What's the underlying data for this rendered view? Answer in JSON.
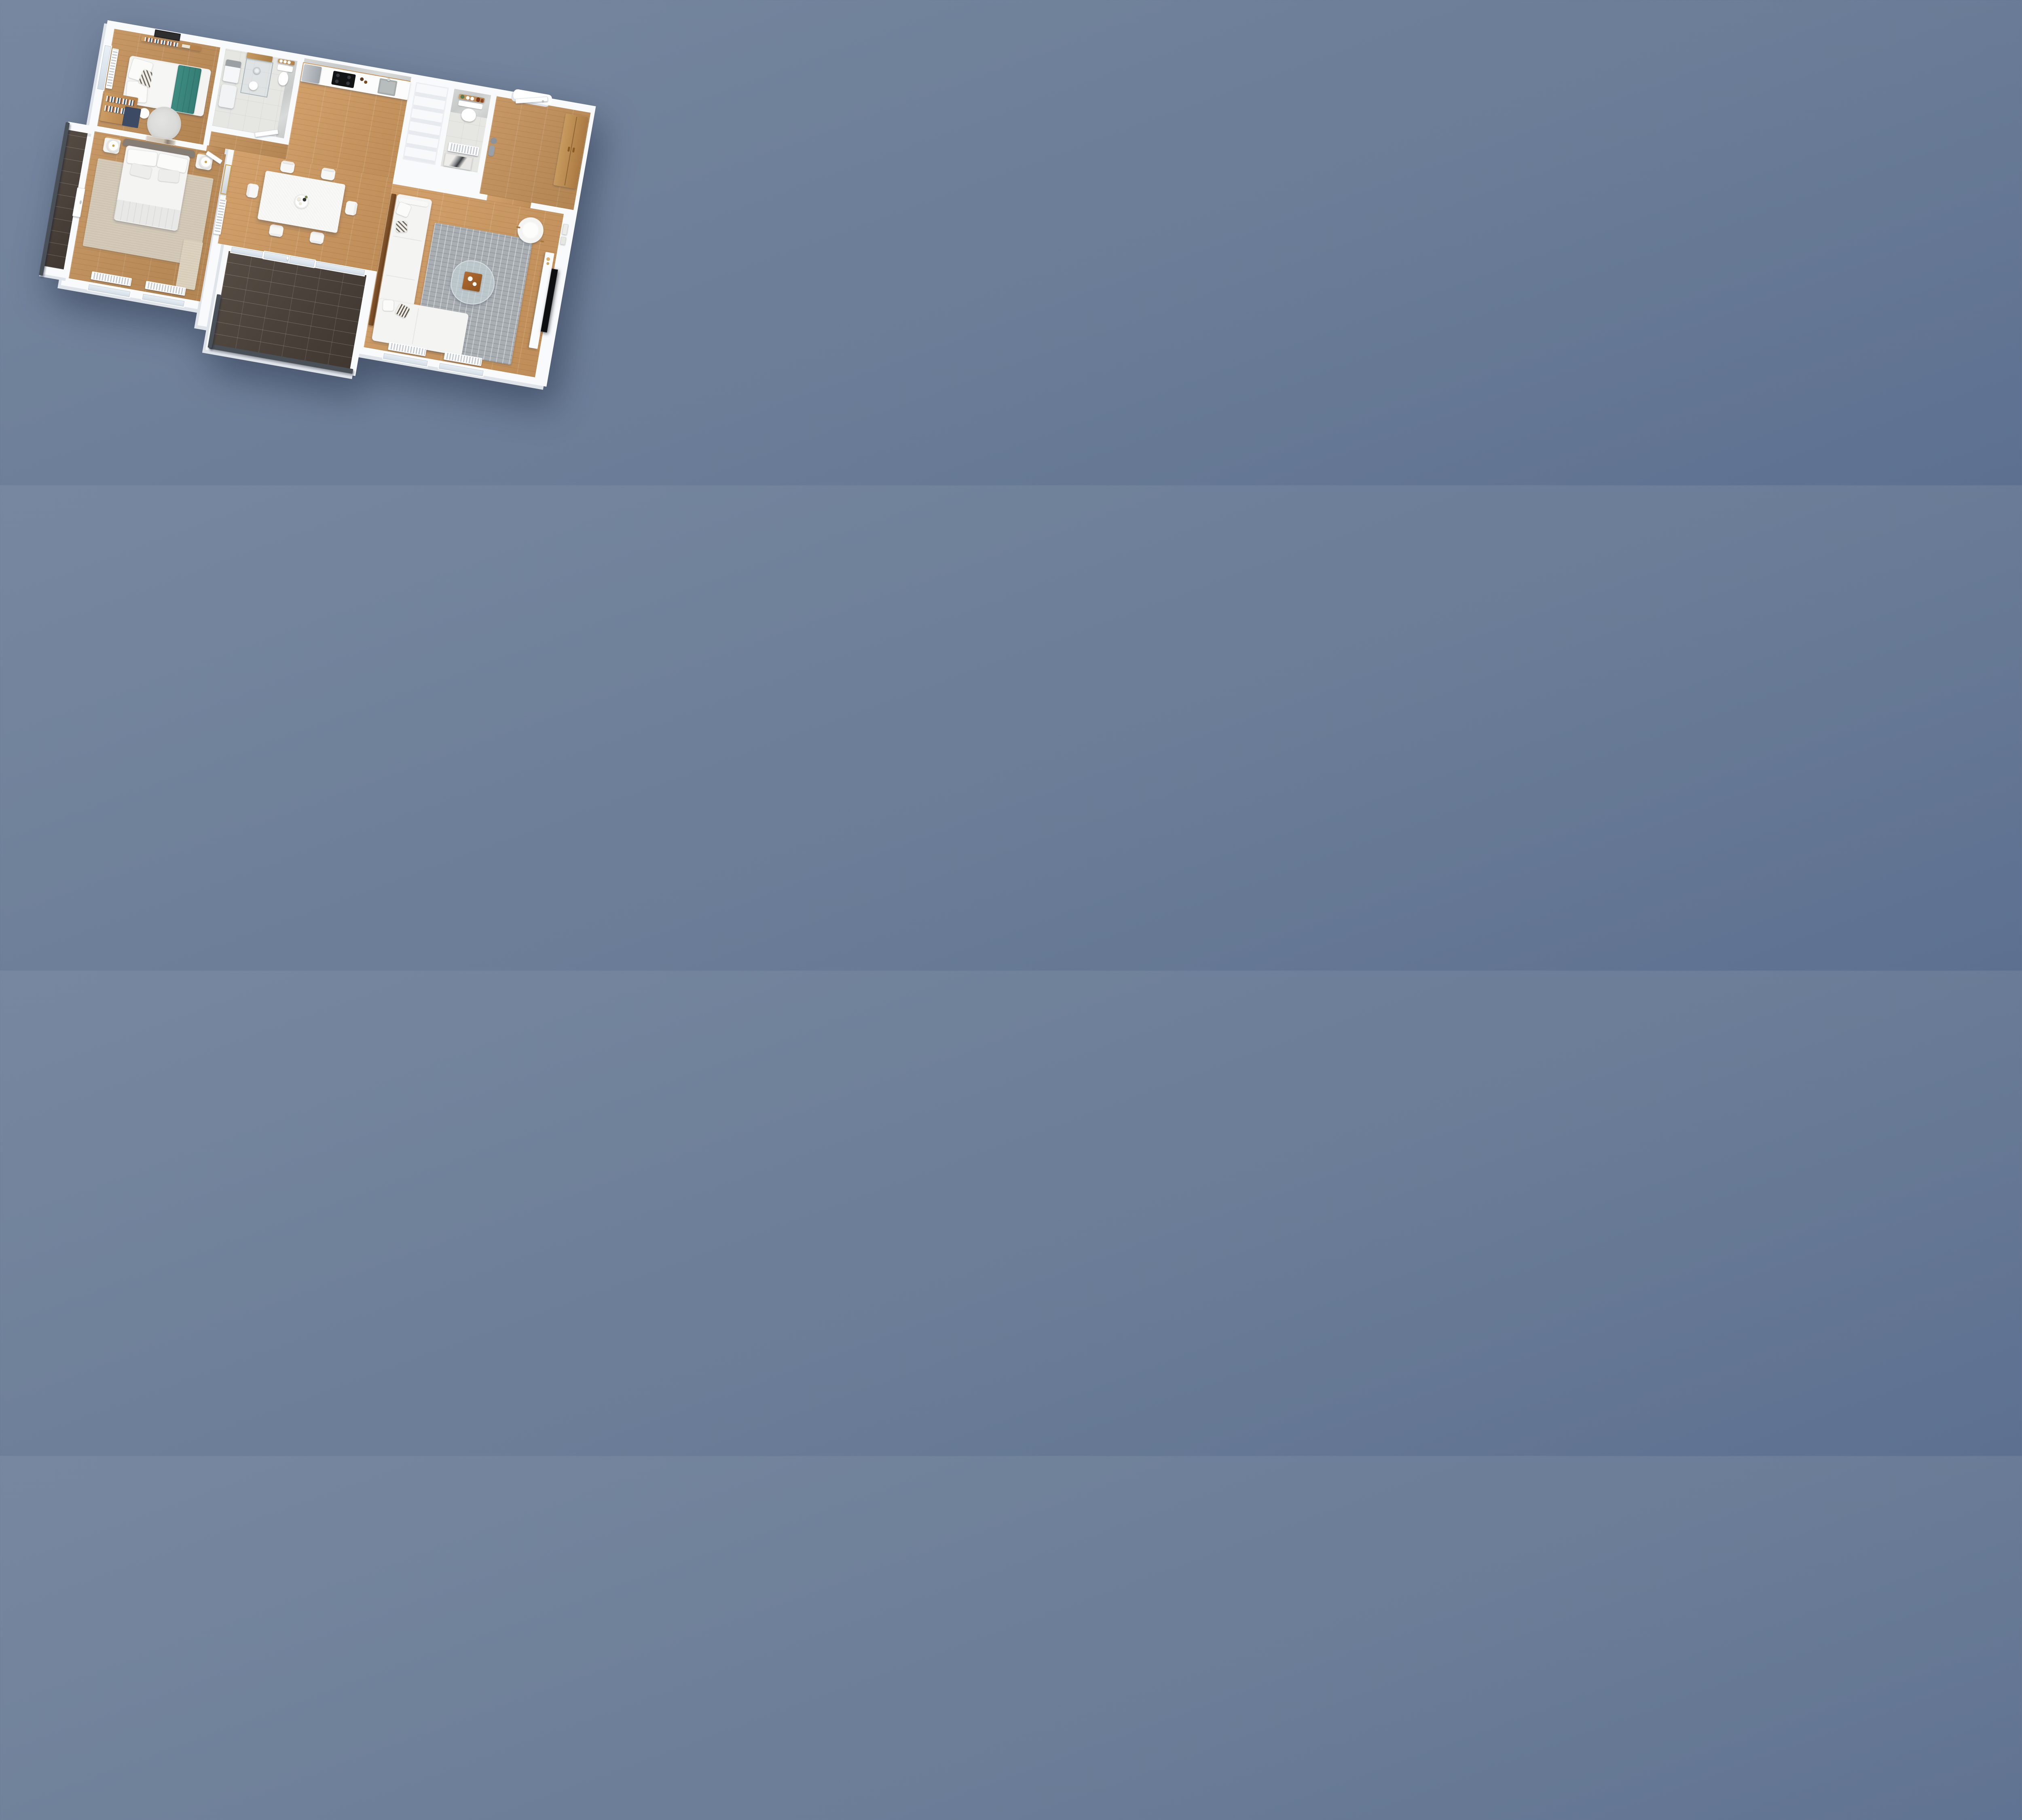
{
  "scene": {
    "title": "3D rendered apartment floor plan, top-down axonometric view",
    "view": "top-down 3d render",
    "no_visible_text": true
  },
  "colors": {
    "bg_top": "#77879f",
    "bg_mid": "#6b7d97",
    "bg_bottom": "#5d7090",
    "wall": "#f9fafb",
    "wall_shade": "#dfe3ea",
    "wood": "#c2905a",
    "tile_dark": "#4a4138",
    "bath_floor": "#e6e6e3",
    "teal": "#3e8c82",
    "rug_gray": "#a9aeb3",
    "rug_beige": "#cfc5b2",
    "railing": "#4a5058",
    "headboard": "#867d75"
  },
  "rooms": [
    {
      "id": "bedroom-small",
      "name": "Small bedroom: single bed with teal blanket, wall shelf with books, framed bicycle picture, bookcase desk, chair, round rug, window with radiator"
    },
    {
      "id": "bathroom",
      "name": "Bathroom: walk-in shower with wood accent wall and rain head, glass enclosure, stool, toilet with paper tray, washing machine, water heater"
    },
    {
      "id": "kitchen",
      "name": "Kitchen: white counter with fridge, black induction hob, oven, gray sink with faucet, oil bottles, marble backsplash"
    },
    {
      "id": "pantry",
      "name": "Hall closet with white shelving"
    },
    {
      "id": "wc",
      "name": "Guest WC: toilet, shelf tray with plant and paper rolls, soap bottles, towel radiator, abstract art"
    },
    {
      "id": "entry",
      "name": "Entry hall: entrance door opening, wooden wardrobe, coat hooks with robe"
    },
    {
      "id": "bedroom-master",
      "name": "Master bedroom: double bed with gray headboard, pillows, two nightstands with lamps, artwork, beige rug, runner, two windows with radiators, balcony door, leaning gold mirror"
    },
    {
      "id": "dining",
      "name": "Dining area: table with white tablecloth, six white chairs, centerpiece tray with candles, radiator, french doors to balcony"
    },
    {
      "id": "living",
      "name": "Living room: white sectional sofa with striped pillows, gray patterned rug, glass coffee table with wooden tray, armchair, wall TV with console, windows with radiators"
    },
    {
      "id": "balcony-main",
      "name": "Main balcony: dark wood-look tile, dark gray railing"
    },
    {
      "id": "balcony-left",
      "name": "Side balcony: dark wood-look tile, dark gray railing"
    }
  ]
}
